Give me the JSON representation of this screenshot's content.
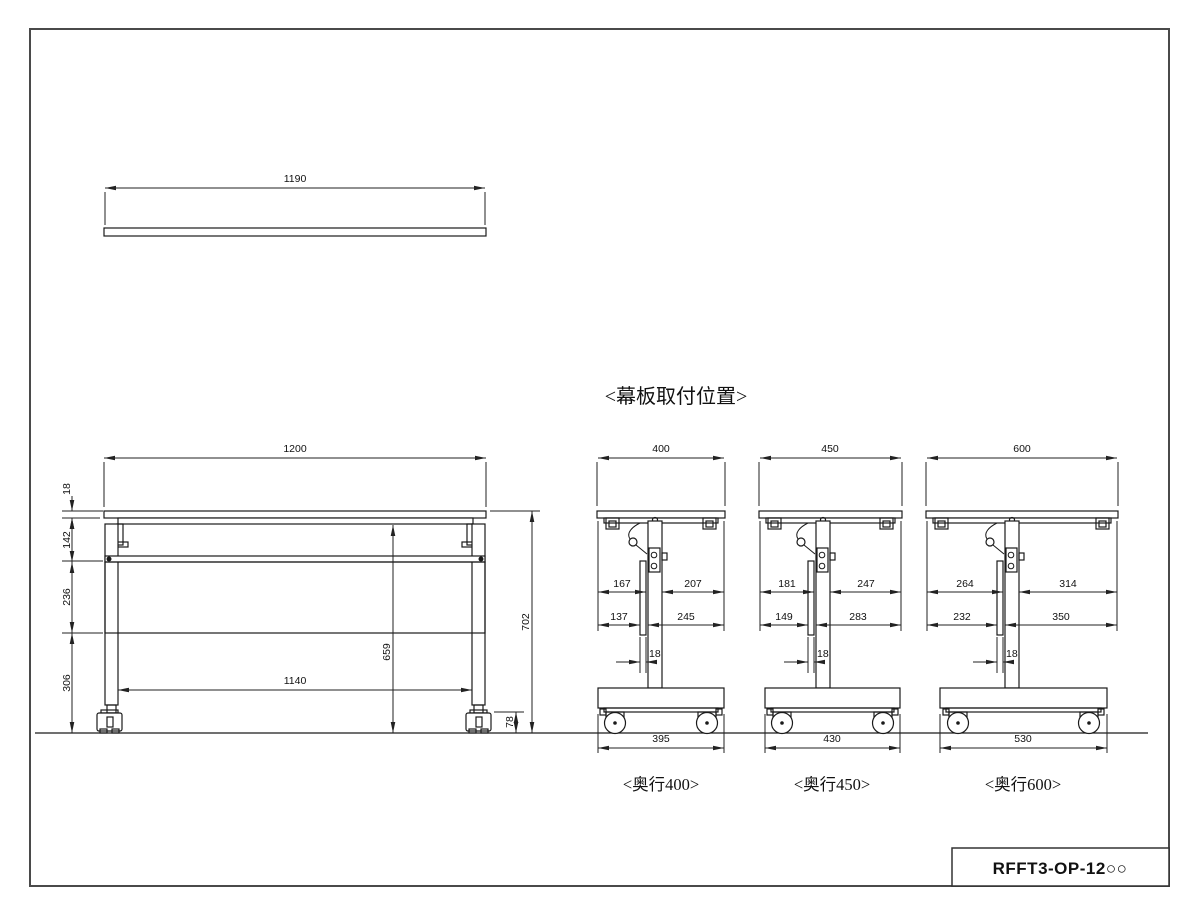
{
  "drawing": {
    "section_title": "<幕板取付位置>",
    "title_block": {
      "part_number": "RFFT3-OP-12○○"
    },
    "top_view": {
      "width": "1190"
    },
    "front_view": {
      "width": "1200",
      "top_thickness": "18",
      "bracket_zone_height": "142",
      "panel_height": "236",
      "lower_clearance": "306",
      "inner_leg_span": "1140",
      "underside_height": "659",
      "overall_height": "702",
      "caster_height": "78"
    },
    "side_views": [
      {
        "caption": "<奥行400>",
        "depth": "400",
        "upper_front": "167",
        "upper_rear": "207",
        "lower_front": "137",
        "lower_rear": "245",
        "panel_thickness": "18",
        "base_width": "395"
      },
      {
        "caption": "<奥行450>",
        "depth": "450",
        "upper_front": "181",
        "upper_rear": "247",
        "lower_front": "149",
        "lower_rear": "283",
        "panel_thickness": "18",
        "base_width": "430"
      },
      {
        "caption": "<奥行600>",
        "depth": "600",
        "upper_front": "264",
        "upper_rear": "314",
        "lower_front": "232",
        "lower_rear": "350",
        "panel_thickness": "18",
        "base_width": "530"
      }
    ]
  }
}
